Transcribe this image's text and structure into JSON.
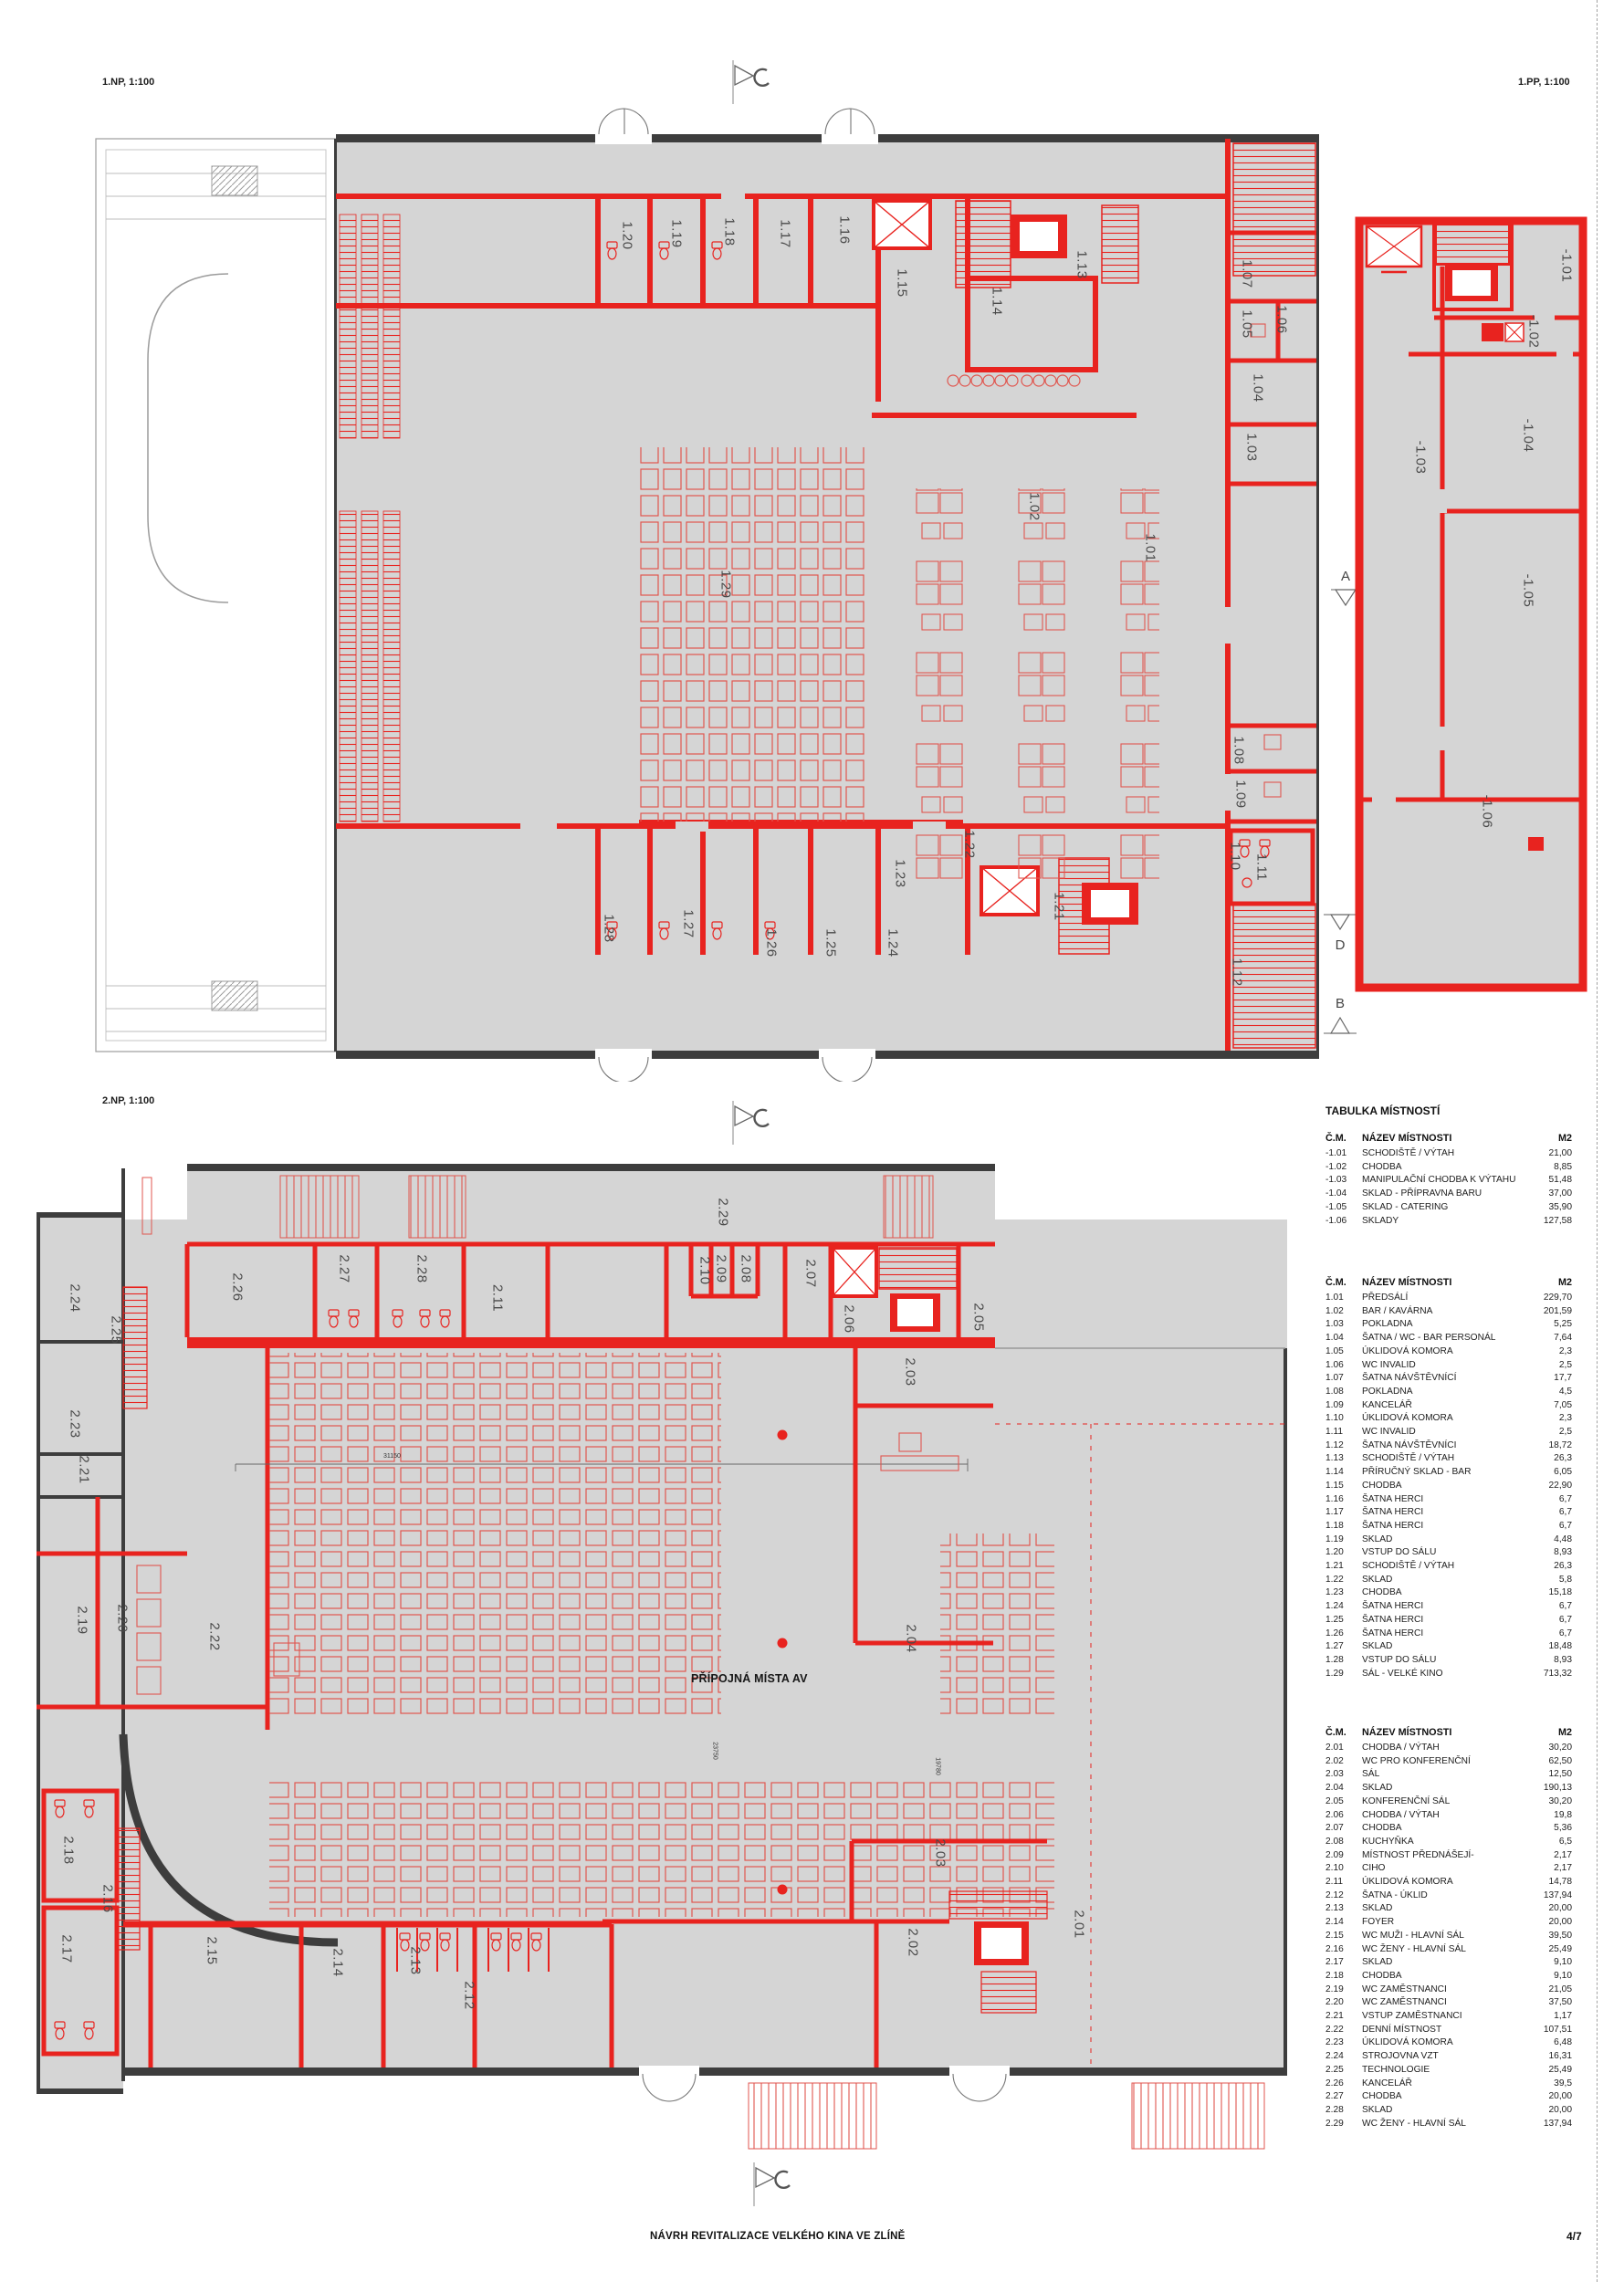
{
  "sheet": {
    "footer_title": "NÁVRH REVITALIZACE VELKÉHO KINA VE ZLÍNĚ",
    "page_number": "4/7"
  },
  "plan_titles": {
    "np1": "1.NP, 1:100",
    "pp1": "1.PP, 1:100",
    "np2": "2.NP, 1:100"
  },
  "plans": {
    "np1": {
      "rooms": [
        "1.20",
        "1.19",
        "1.18",
        "1.17",
        "1.16",
        "1.15",
        "1.14",
        "1.13",
        "1.07",
        "1.06",
        "1.05",
        "1.04",
        "1.03",
        "1.29",
        "1.02",
        "1.01",
        "1.08",
        "1.09",
        "1.10",
        "1.11",
        "1.22",
        "1.23",
        "1.21",
        "1.28",
        "1.27",
        "1.26",
        "1.25",
        "1.24",
        "1.12"
      ]
    },
    "np2": {
      "rooms": [
        "2.24",
        "2.25",
        "2.23",
        "2.21",
        "2.19",
        "2.20",
        "2.22",
        "2.26",
        "2.27",
        "2.28",
        "2.11",
        "2.29",
        "2.10",
        "2.09",
        "2.08",
        "2.07",
        "2.06",
        "2.05",
        "2.03",
        "2.04",
        "2.03",
        "2.02",
        "2.01",
        "2.16",
        "2.15",
        "2.14",
        "2.13",
        "2.18",
        "2.17",
        "2.12"
      ]
    },
    "pp1": {
      "rooms": [
        "-1.01",
        "-1.02",
        "-1.03",
        "-1.04",
        "-1.05",
        "-1.06"
      ]
    }
  },
  "annotations": {
    "av_note": "PŘÍPOJNÁ MÍSTA AV",
    "dim_h": "31150",
    "dim_v1": "23750",
    "dim_v2": "19780"
  },
  "section_markers": [
    "A",
    "D",
    "B"
  ],
  "tables": {
    "title": "TABULKA MÍSTNOSTÍ",
    "header": {
      "num": "Č.M.",
      "name": "NÁZEV MÍSTNOSTI",
      "area": "M2"
    },
    "groups": [
      {
        "rows": [
          [
            "-1.01",
            "SCHODIŠTĚ / VÝTAH",
            "21,00"
          ],
          [
            "-1.02",
            "CHODBA",
            "8,85"
          ],
          [
            "-1.03",
            "MANIPULAČNÍ CHODBA K VÝTAHU",
            "51,48"
          ],
          [
            "-1.04",
            "SKLAD - PŘÍPRAVNA BARU",
            "37,00"
          ],
          [
            "-1.05",
            "SKLAD - CATERING",
            "35,90"
          ],
          [
            "-1.06",
            "SKLADY",
            "127,58"
          ]
        ]
      },
      {
        "rows": [
          [
            "1.01",
            "PŘEDSÁLÍ",
            "229,70"
          ],
          [
            "1.02",
            "BAR / KAVÁRNA",
            "201,59"
          ],
          [
            "1.03",
            "POKLADNA",
            "5,25"
          ],
          [
            "1.04",
            "ŠATNA / WC - BAR PERSONÁL",
            "7,64"
          ],
          [
            "1.05",
            "ÚKLIDOVÁ KOMORA",
            "2,3"
          ],
          [
            "1.06",
            "WC INVALID",
            "2,5"
          ],
          [
            "1.07",
            "ŠATNA NÁVŠTĚVNÍCÍ",
            "17,7"
          ],
          [
            "1.08",
            "POKLADNA",
            "4,5"
          ],
          [
            "1.09",
            "KANCELÁŘ",
            "7,05"
          ],
          [
            "1.10",
            "ÚKLIDOVÁ KOMORA",
            "2,3"
          ],
          [
            "1.11",
            "WC INVALID",
            "2,5"
          ],
          [
            "1.12",
            "ŠATNA NÁVŠTĚVNÍCI",
            "18,72"
          ],
          [
            "1.13",
            "SCHODIŠTĚ / VÝTAH",
            "26,3"
          ],
          [
            "1.14",
            "PŘÍRUČNÝ SKLAD - BAR",
            "6,05"
          ],
          [
            "1.15",
            "CHODBA",
            "22,90"
          ],
          [
            "1.16",
            "ŠATNA HERCI",
            "6,7"
          ],
          [
            "1.17",
            "ŠATNA HERCI",
            "6,7"
          ],
          [
            "1.18",
            "ŠATNA HERCI",
            "6,7"
          ],
          [
            "1.19",
            "SKLAD",
            "4,48"
          ],
          [
            "1.20",
            "VSTUP DO SÁLU",
            "8,93"
          ],
          [
            "1.21",
            "SCHODIŠTĚ / VÝTAH",
            "26,3"
          ],
          [
            "1.22",
            "SKLAD",
            "5,8"
          ],
          [
            "1.23",
            "CHODBA",
            "15,18"
          ],
          [
            "1.24",
            "ŠATNA HERCI",
            "6,7"
          ],
          [
            "1.25",
            "ŠATNA HERCI",
            "6,7"
          ],
          [
            "1.26",
            "ŠATNA HERCI",
            "6,7"
          ],
          [
            "1.27",
            "SKLAD",
            "18,48"
          ],
          [
            "1.28",
            "VSTUP DO SÁLU",
            "8,93"
          ],
          [
            "1.29",
            "SÁL - VELKÉ KINO",
            "713,32"
          ]
        ]
      },
      {
        "rows": [
          [
            "2.01",
            "CHODBA / VÝTAH",
            "30,20"
          ],
          [
            "2.02",
            "WC PRO KONFERENČNÍ",
            "62,50"
          ],
          [
            "2.03",
            "SÁL",
            "12,50"
          ],
          [
            "2.04",
            "SKLAD",
            "190,13"
          ],
          [
            "2.05",
            "KONFERENČNÍ SÁL",
            "30,20"
          ],
          [
            "2.06",
            "CHODBA / VÝTAH",
            "19,8"
          ],
          [
            "2.07",
            "CHODBA",
            "5,36"
          ],
          [
            "2.08",
            "KUCHYŇKA",
            "6,5"
          ],
          [
            "2.09",
            "MÍSTNOST PŘEDNÁŠEJÍ-",
            "2,17"
          ],
          [
            "2.10",
            "CIHO",
            "2,17"
          ],
          [
            "2.11",
            "ÚKLIDOVÁ KOMORA",
            "14,78"
          ],
          [
            "2.12",
            "ŠATNA - ÚKLID",
            "137,94"
          ],
          [
            "2.13",
            "SKLAD",
            "20,00"
          ],
          [
            "2.14",
            "FOYER",
            "20,00"
          ],
          [
            "2.15",
            "WC MUŽI - HLAVNÍ SÁL",
            "39,50"
          ],
          [
            "2.16",
            "WC ŽENY - HLAVNÍ SÁL",
            "25,49"
          ],
          [
            "2.17",
            "SKLAD",
            "9,10"
          ],
          [
            "2.18",
            "CHODBA",
            "9,10"
          ],
          [
            "2.19",
            "WC ZAMĚSTNANCI",
            "21,05"
          ],
          [
            "2.20",
            "WC ZAMĚSTNANCI",
            "37,50"
          ],
          [
            "2.21",
            "VSTUP ZAMĚSTNANCI",
            "1,17"
          ],
          [
            "2.22",
            "DENNÍ MÍSTNOST",
            "107,51"
          ],
          [
            "2.23",
            "ÚKLIDOVÁ KOMORA",
            "6,48"
          ],
          [
            "2.24",
            "STROJOVNA VZT",
            "16,31"
          ],
          [
            "2.25",
            "TECHNOLOGIE",
            "25,49"
          ],
          [
            "2.26",
            "KANCELÁŘ",
            "39,5"
          ],
          [
            "2.27",
            "CHODBA",
            "20,00"
          ],
          [
            "2.28",
            "SKLAD",
            "20,00"
          ],
          [
            "2.29",
            "WC ŽENY - HLAVNÍ SÁL",
            "137,94"
          ]
        ]
      }
    ]
  },
  "colors": {
    "wall_red": "#e8231f",
    "wall_dark": "#3d3d3d",
    "floor_gray": "#d5d5d5"
  }
}
